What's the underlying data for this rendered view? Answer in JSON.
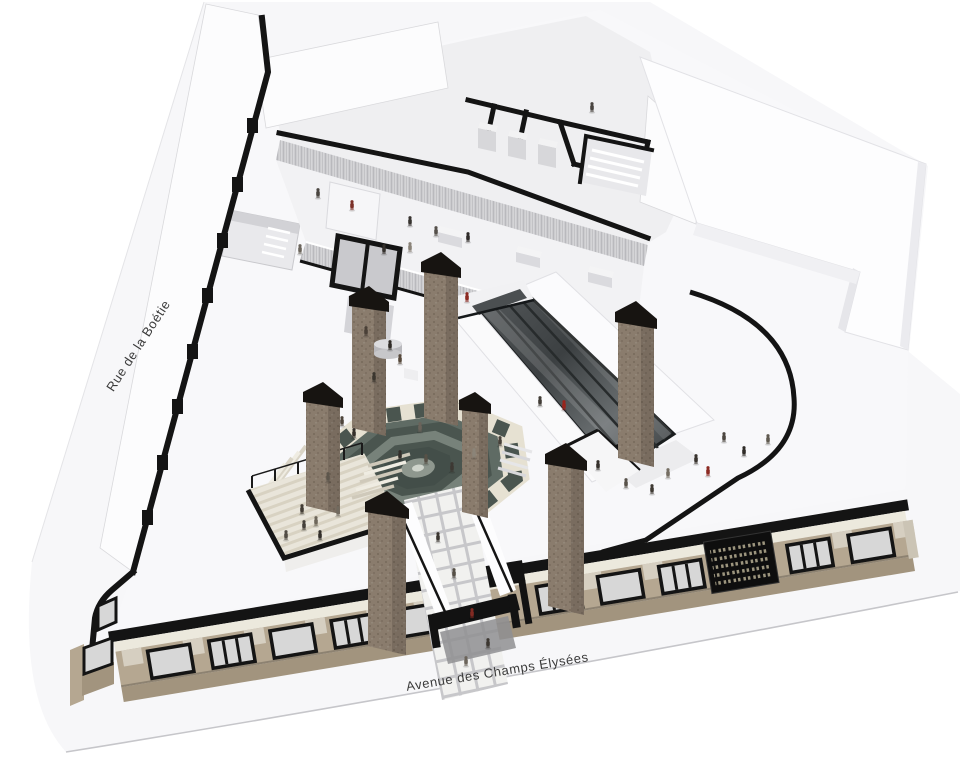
{
  "labels": {
    "street_left": "Rue de la Boétie",
    "street_bottom": "Avenue des Champs Élysées"
  },
  "palette": {
    "bg": "#ffffff",
    "ground": "#f7f7f9",
    "curb": "#c6c6ca",
    "site": "#f8f8fa",
    "wall": "#141414",
    "roof": "#fcfcfd",
    "roof_edge": "#d9d9dc",
    "interior": "#efeff1",
    "mezz": "#f2f2f4",
    "rib_light": "#d8d8db",
    "rib_dark": "#b9b9bd",
    "pillar": "#8a7c6d",
    "pillar_dark": "#6f6254",
    "pillar_light": "#9a8e80",
    "cap": "#171411",
    "plaza_dark": "#4a554f",
    "plaza_mid": "#5f6b64",
    "plaza_ring": "#77827a",
    "checker_cream": "#e6e1d2",
    "deck_light": "#e9e5da",
    "deck_dark": "#d8d2c2",
    "walk_tile": "#f1f1ef",
    "walk_joint": "#c7c7ca",
    "esc_dark": "#3f4345",
    "esc_mid": "#5c6163",
    "glass": "#d7d7d7",
    "facade_tan": "#b5a791",
    "facade_tan_dark": "#a2947e",
    "facade_cream": "#ece9dd",
    "facade_black": "#141414",
    "grille_dot": "#b5ad92",
    "label": "#3b3b3b"
  }
}
